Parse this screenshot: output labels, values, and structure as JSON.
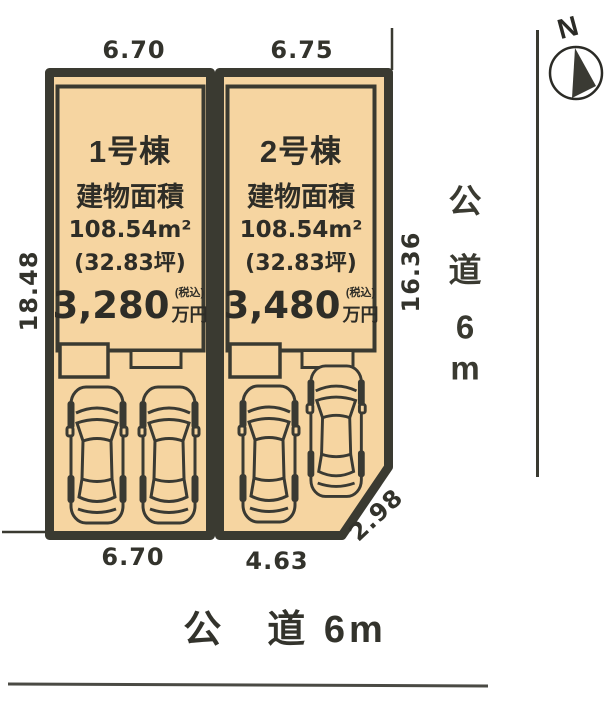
{
  "site": {
    "dim_left": "18.48",
    "dim_right": "16.36"
  },
  "plots": [
    {
      "name": "1号棟",
      "area_label": "建物面積",
      "area_m2": "108.54m²",
      "area_tsubo": "(32.83坪)",
      "price": "3,280",
      "price_tax_note": "(税込)",
      "price_unit": "万円",
      "frontage_top": "6.70",
      "frontage_bottom": "6.70"
    },
    {
      "name": "2号棟",
      "area_label": "建物面積",
      "area_m2": "108.54m²",
      "area_tsubo": "(32.83坪)",
      "price": "3,480",
      "price_tax_note": "(税込)",
      "price_unit": "万円",
      "frontage_top": "6.75",
      "frontage_bottom": "4.63",
      "corner_cut": "2.98"
    }
  ],
  "roads": {
    "right": {
      "chars": [
        "公",
        "道",
        "6",
        "m"
      ]
    },
    "bottom": {
      "label": "公　道 6m"
    }
  },
  "compass": {
    "label": "N"
  },
  "colors": {
    "background": "#ffffff",
    "plot_fill": "#f6d5a1",
    "line": "#3a3a31",
    "text": "#2b2b26"
  }
}
